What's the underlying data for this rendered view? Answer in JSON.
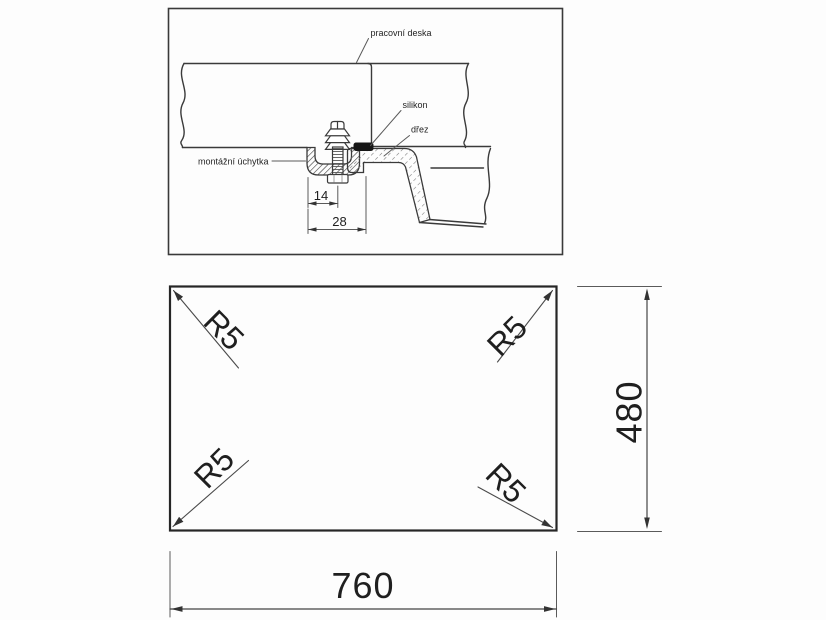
{
  "colors": {
    "background": "#fdfdfd",
    "line": "#3a3a3a",
    "plan_line": "#262626",
    "text": "#1f1f1f",
    "silicone_fill": "#161616"
  },
  "detail": {
    "labels": {
      "worktop": "pracovní deska",
      "silicone": "silikon",
      "sink": "dřez",
      "clip": "montážní úchytka"
    },
    "dimensions": {
      "clip_screw_offset": "14",
      "clip_total_width": "28"
    }
  },
  "plan": {
    "corner_radii": {
      "top_left": "R5",
      "top_right": "R5",
      "bottom_left": "R5",
      "bottom_right": "R5"
    },
    "dimensions": {
      "width": "760",
      "height": "480"
    }
  }
}
